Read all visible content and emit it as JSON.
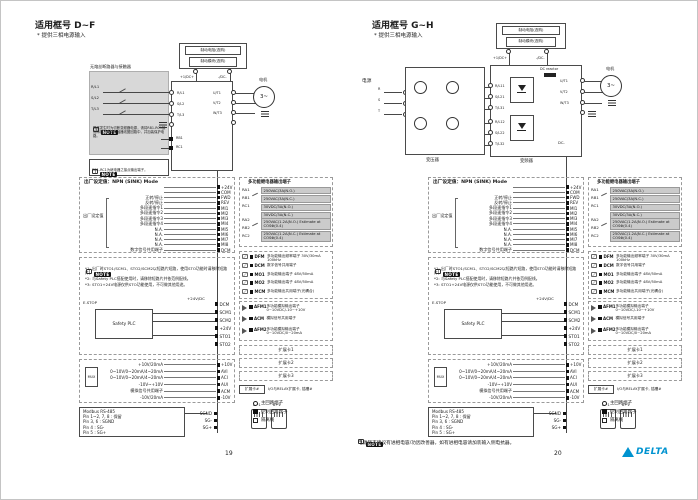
{
  "note_badge": "NOTE",
  "brand": {
    "logo_text": "DELTA",
    "logo_color": "#0093d0"
  },
  "pages": {
    "left": {
      "title": "适用框号 D~F",
      "subtitle": "* 提供三相电源输入",
      "page_number": "19",
      "main": {
        "breaker_box_title": "无熔丝断路器与接触器",
        "inputs": [
          "R/L1",
          "S/L2",
          "T/L3"
        ],
        "note1_text": "异常发生时为切断变频器电源，请将RB1-RC1接点串接于电磁接触器线圈回路中，并加装保护电路。",
        "note2_text": "RB1-RC1为继电器之接点输出端子。",
        "relay_terms": [
          "RB1",
          "RC1"
        ],
        "brake_resistor": "制动电阻(选购)",
        "brake_module": "制动模块(选购)",
        "dc_plus": "+1/DC+",
        "dc_minus": "-/DC-",
        "outputs": [
          "U/T1",
          "V/T2",
          "W/T3"
        ],
        "motor_label": "电机",
        "motor_symbol": "3~"
      }
    },
    "right": {
      "title": "适用框号 G~H",
      "subtitle": "* 提供三相电源输入",
      "page_number": "20",
      "main": {
        "power_label": "电源",
        "phase_labels": [
          "R",
          "S",
          "T"
        ],
        "transformer_label": "变压器",
        "inverter_label": "变频器",
        "inputs_group1": [
          "R/L11",
          "S/L21",
          "T/L31"
        ],
        "inputs_group2": [
          "R/L12",
          "S/L22",
          "T/L32"
        ],
        "dc_reactor_label": "DC reactor",
        "dc_minus_inner": "DC-",
        "brake_resistor": "制动电阻(选购)",
        "brake_module": "制动模块(选购)",
        "dc_plus": "+1/DC+",
        "dc_minus": "-/DC-",
        "outputs": [
          "U/T1",
          "V/T2",
          "W/T3"
        ],
        "motor_label": "电机",
        "motor_symbol": "3~"
      },
      "footer_note": "电源侧不建议有进相电容/功因改善器，如有进相电容请加装输入侧电抗器。"
    }
  },
  "control": {
    "mode_title": "出厂设定值：NPN (SINK) Mode",
    "factory_label": "出厂设定值",
    "io_rows": [
      {
        "label": "",
        "term": "+24V"
      },
      {
        "label": "",
        "term": "COM"
      },
      {
        "label": "正转/停止",
        "term": "FWD"
      },
      {
        "label": "反转/停止",
        "term": "REV"
      },
      {
        "label": "多段速指令1",
        "term": "MI1"
      },
      {
        "label": "多段速指令2",
        "term": "MI2"
      },
      {
        "label": "多段速指令3",
        "term": "MI3"
      },
      {
        "label": "多段速指令4",
        "term": "MI4"
      },
      {
        "label": "N.A.",
        "term": "MI5"
      },
      {
        "label": "N.A.",
        "term": "MI6"
      },
      {
        "label": "N.A.",
        "term": "MI7"
      },
      {
        "label": "N.A.",
        "term": "MI8"
      },
      {
        "label": "数字信号共用端子",
        "term": "DCM"
      }
    ],
    "relay": {
      "title": "多功能继电器输出端子",
      "group1_terms": [
        "RA1",
        "RB1",
        "RC1"
      ],
      "group1_specs": [
        "250VAC/3A(N.O.)",
        "250VAC/3A(N.C.)",
        "30VDC/3A(N.O.)",
        "30VDC/3A(N.C.)"
      ],
      "group2_terms": [
        "RA2",
        "RB2",
        "RC2"
      ],
      "group2_specs": [
        "250VAC/1.2A(N.O.) Estimate at COSΦ(0.4)",
        "250VAC/1.2A(N.C.) Estimate at COSΦ(0.4)"
      ]
    },
    "transistor_rows": [
      {
        "term": "DFM",
        "desc": "多功能输出频率端子 30V/30mA 100kHz"
      },
      {
        "term": "DCM",
        "desc": "数字信号共用端子"
      },
      {
        "term": "MO1",
        "desc": "多功能输出端子 48V/50mA"
      },
      {
        "term": "MO2",
        "desc": "多功能输出端子 48V/50mA"
      },
      {
        "term": "MCM",
        "desc": "多功能输出共用端子(光耦合)"
      }
    ],
    "analog_out_rows": [
      {
        "term": "AFM1",
        "desc": "多功能模拟输出端子 0~10VDC/-10~+10V"
      },
      {
        "term": "ACM",
        "desc": "模拟信号共用端子"
      },
      {
        "term": "AFM2",
        "desc": "多功能模拟输出端子 0~10VDC/0~20mA"
      }
    ],
    "sto": {
      "notes": [
        "*1: 出厂时STO1/SCM1、STO2/SCM2以短路片短路，使用STO功能时请移除短路片。",
        "*2: 与Safety PLC搭配使用时，请移除短路片并依范例配线。",
        "*3: STO1+24V电源仅供STO功能使用，不可做其他用途。"
      ],
      "estop_label": "E.STOP",
      "plc_label": "Safety PLC",
      "supply_label": "+24V/DC",
      "terms": [
        "DCM",
        "SCM1",
        "SCM2",
        "+24V",
        "STO1",
        "STO2"
      ]
    },
    "analog_in_rows": [
      {
        "label": "+10V/20mA",
        "term": "+10V"
      },
      {
        "label": "0~10V/0~20mA/4~20mA",
        "term": "AVI"
      },
      {
        "label": "0~10V/0~20mA/4~20mA",
        "term": "ACI"
      },
      {
        "label": "-10V~+10V",
        "term": "AUI"
      },
      {
        "label": "模拟信号共用端子",
        "term": "ACM"
      },
      {
        "label": "-10V/20mA",
        "term": "-10V"
      }
    ],
    "mux_label": "MUX",
    "rs485": {
      "lines": [
        "Modbus RS-485",
        "Pin 1~2, 7, 8 : 保留",
        "Pin 3, 6 : SGND",
        "Pin 4 : SG-",
        "Pin 5 : SG+"
      ],
      "terms": [
        "SGND",
        "SG-",
        "SG+"
      ],
      "jack_label": "8←1"
    },
    "expansion_boxes": [
      "扩展卡1",
      "扩展卡2",
      "扩展卡3"
    ],
    "expansion_note": {
      "box": "扩展卡#",
      "text": "I/O与RELAY扩展卡, 插槽#"
    },
    "legend": [
      {
        "symbol": "circle",
        "label": "主回路端子"
      },
      {
        "symbol": "square-filled",
        "label": "控制回路端子"
      },
      {
        "symbol": "square-open",
        "label": "隔离线"
      }
    ]
  }
}
